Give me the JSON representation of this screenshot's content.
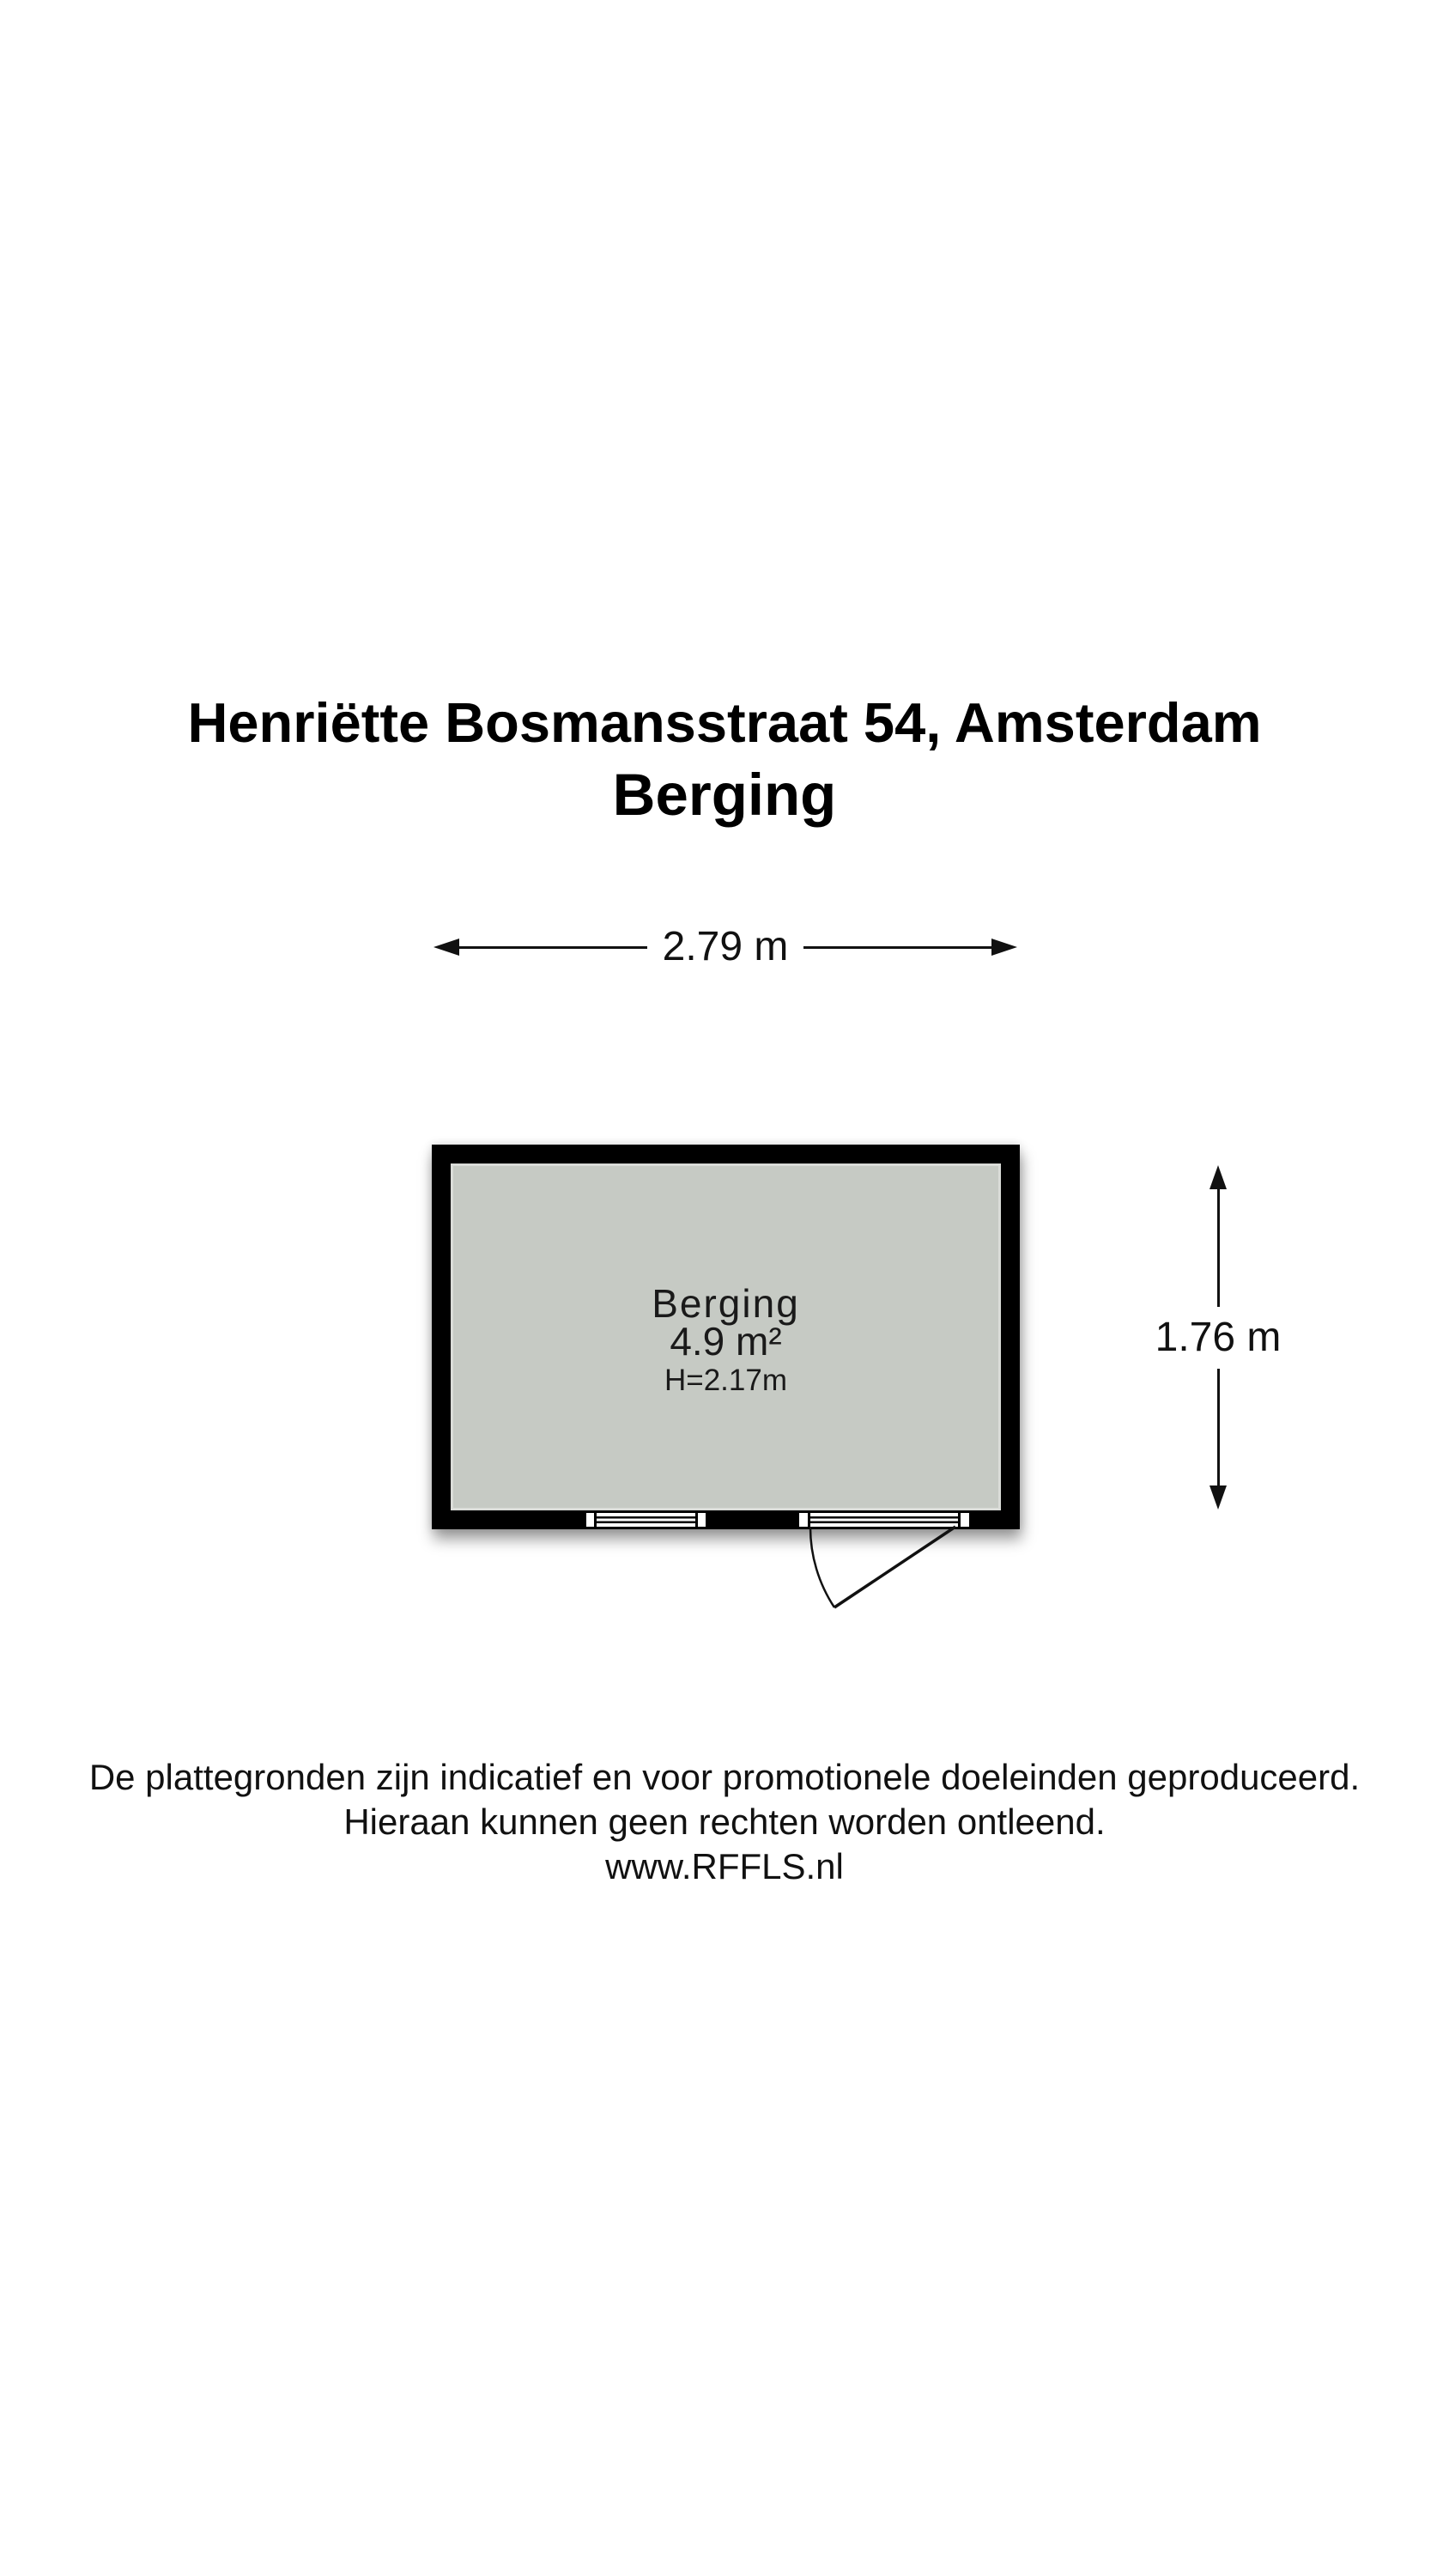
{
  "title": {
    "line1": "Henriëtte Bosmansstraat 54, Amsterdam",
    "line2": "Berging"
  },
  "floorplan": {
    "room": {
      "label": "Berging",
      "area": "4.9 m²",
      "ceiling_height": "H=2.17m"
    },
    "dimensions": {
      "width": "2.79 m",
      "height": "1.76 m"
    },
    "features": [
      "window",
      "door-with-swing-arc"
    ]
  },
  "colors": {
    "background": "#ffffff",
    "wall": "#000000",
    "floor": "#c6cac4",
    "ink": "#111111"
  },
  "footer": {
    "line1": "De plattegronden zijn indicatief en voor promotionele doeleinden geproduceerd.",
    "line2": "Hieraan kunnen geen rechten worden ontleend.",
    "line3": "www.RFFLS.nl"
  }
}
